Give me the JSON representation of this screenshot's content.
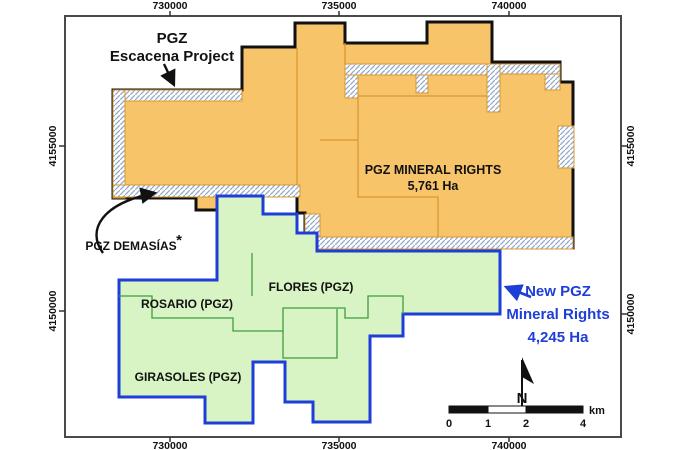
{
  "labels": {
    "project_line1": "PGZ",
    "project_line2": "Escacena Project",
    "mineral_line1": "PGZ MINERAL RIGHTS",
    "mineral_line2": "5,761 Ha",
    "demasias": "PGZ DEMASÍAS",
    "demasias_mark": "*",
    "rosario": "ROSARIO (PGZ)",
    "flores": "FLORES (PGZ)",
    "girasoles": "GIRASOLES (PGZ)",
    "new_line1": "New PGZ",
    "new_line2": "Mineral Rights",
    "new_line3": "4,245 Ha"
  },
  "axes": {
    "top": [
      {
        "label": "730000"
      },
      {
        "label": "735000"
      },
      {
        "label": "740000"
      }
    ],
    "bottom": [
      {
        "label": "730000"
      },
      {
        "label": "735000"
      },
      {
        "label": "740000"
      }
    ],
    "left": [
      {
        "label": "4155000"
      },
      {
        "label": "4150000"
      }
    ],
    "right": [
      {
        "label": "4155000"
      },
      {
        "label": "4150000"
      }
    ]
  },
  "scalebar": {
    "ticks": [
      {
        "label": "0"
      },
      {
        "label": "1"
      },
      {
        "label": "2"
      },
      {
        "label": "4"
      }
    ],
    "unit": "km"
  },
  "north": {
    "label": "N"
  },
  "areas": {
    "pgz_mineral_rights_ha": "5,761",
    "new_pgz_mineral_rights_ha": "4,245"
  },
  "colors": {
    "orange_fill": "#F8C46A",
    "orange_parcel_line": "#D9982F",
    "black_boundary": "#111111",
    "green_fill": "#D8F3C4",
    "green_parcel_line": "#3E9E3E",
    "blue_boundary": "#1E3ED8",
    "blue_text": "#1E3ED8",
    "hatch_line": "#93A9C9",
    "frame_border": "#4A4A4A",
    "background": "#FFFFFF"
  }
}
